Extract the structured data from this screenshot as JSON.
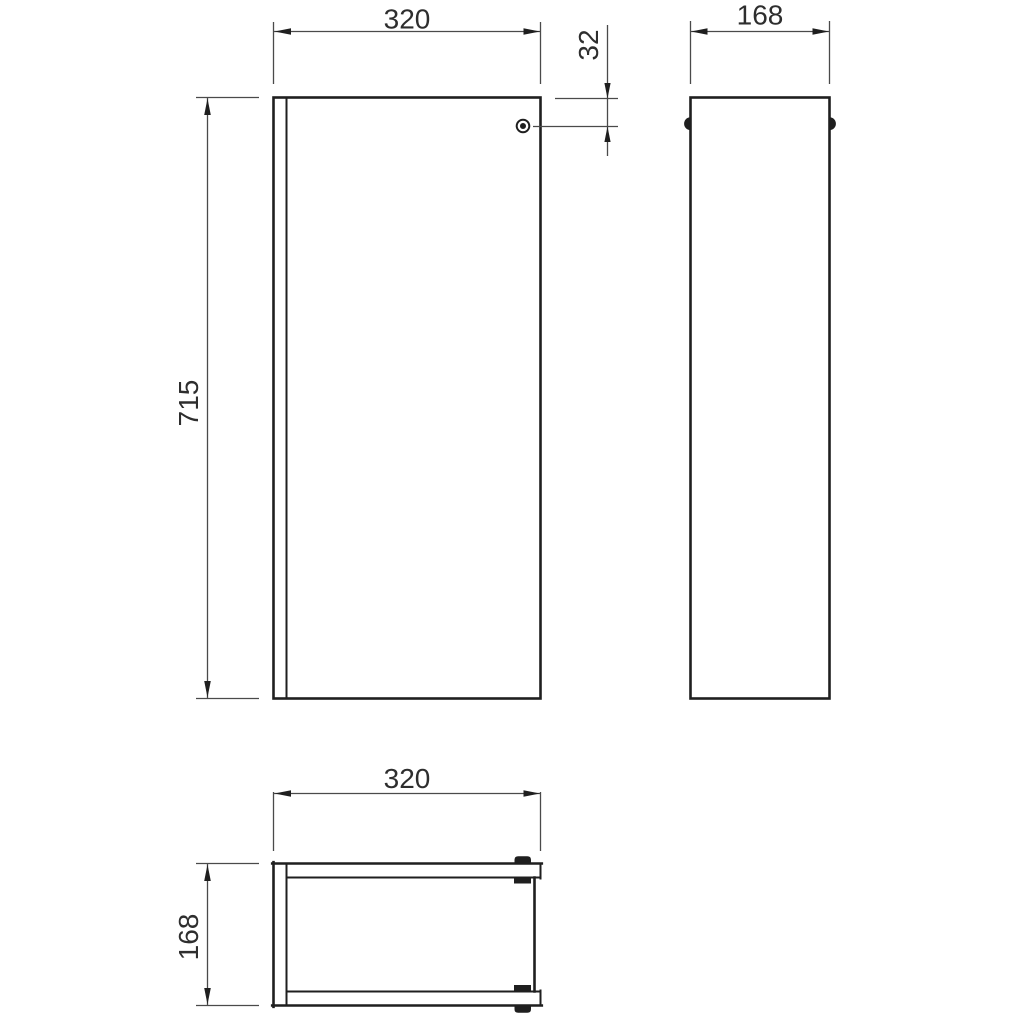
{
  "meta": {
    "drawing_type": "cabinet-dimension-drawing",
    "background_color": "#ffffff",
    "outline_color": "#1f1f1f",
    "dimension_line_color": "#4a4a4a",
    "text_color": "#2e2e2e"
  },
  "views": {
    "front": {
      "width_dim": "320",
      "height_dim": "715",
      "handle_offset_dim": "32"
    },
    "side": {
      "depth_dim": "168"
    },
    "plan": {
      "width_dim": "320",
      "depth_dim": "168"
    }
  }
}
